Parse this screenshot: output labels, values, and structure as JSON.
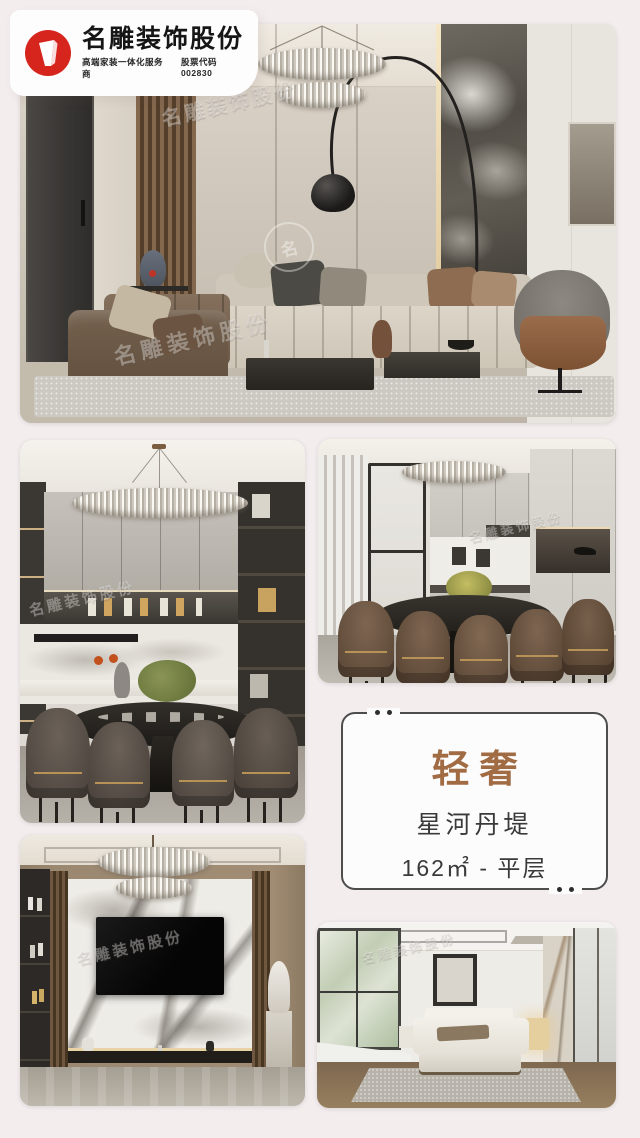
{
  "page": {
    "background": "#f3edee"
  },
  "brand": {
    "name": "名雕装饰股份",
    "tagline": "高端家装一体化服务商",
    "stock_code": "股票代码 002830",
    "logo_red": "#d6251d"
  },
  "watermark": {
    "text": "名雕装饰股份",
    "glyph": "名"
  },
  "info_card": {
    "style_label": "轻奢",
    "project_name": "星河丹堤",
    "area_layout": "162㎡ - 平层",
    "accent_color": "#a16c44"
  }
}
